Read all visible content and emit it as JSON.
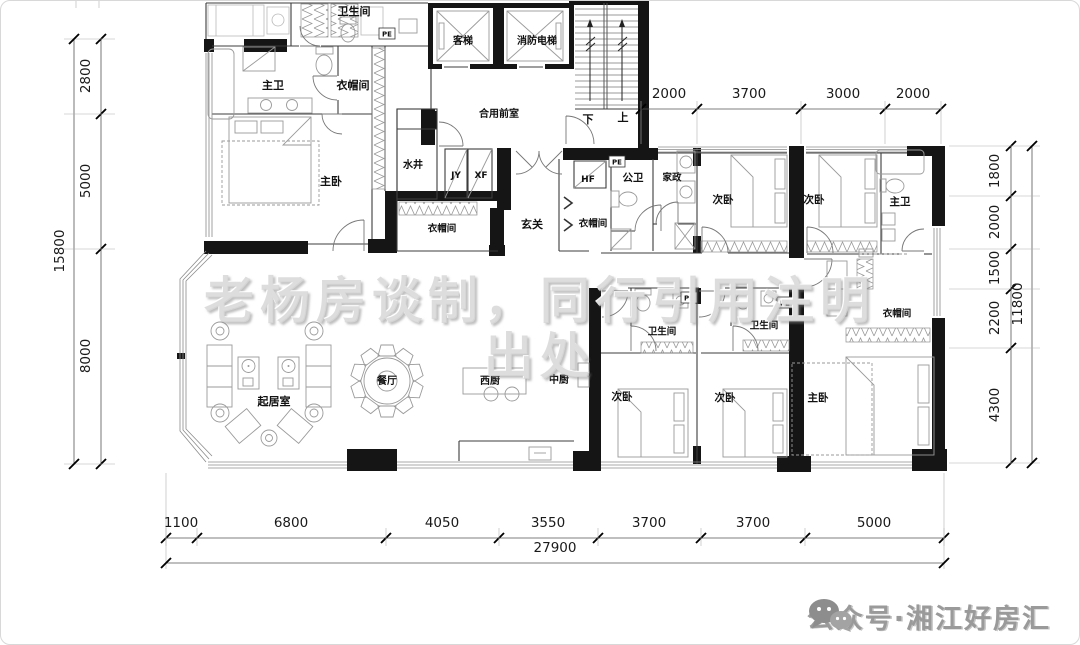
{
  "watermark": {
    "line1": "老杨房谈制，同行引用注明",
    "line2": "出处"
  },
  "footer_logo": {
    "icon": "wechat-bubbles-icon",
    "text": "公众号·湘江好房汇"
  },
  "room_labels": [
    {
      "id": "bath-top",
      "label": "卫生间",
      "x": 353,
      "y": 11,
      "size": 11
    },
    {
      "id": "master-bath-1",
      "label": "主卫",
      "x": 272,
      "y": 85,
      "size": 11
    },
    {
      "id": "closet-1",
      "label": "衣帽间",
      "x": 352,
      "y": 85,
      "size": 11
    },
    {
      "id": "master-bed-1",
      "label": "主卧",
      "x": 330,
      "y": 181,
      "size": 11
    },
    {
      "id": "water-well",
      "label": "水井",
      "x": 412,
      "y": 164,
      "size": 10
    },
    {
      "id": "elevator-passenger",
      "label": "客梯",
      "x": 462,
      "y": 40,
      "size": 10
    },
    {
      "id": "elevator-fire",
      "label": "消防电梯",
      "x": 536,
      "y": 40,
      "size": 10
    },
    {
      "id": "shared-lobby",
      "label": "合用前室",
      "x": 498,
      "y": 113,
      "size": 10
    },
    {
      "id": "stair-down",
      "label": "下",
      "x": 587,
      "y": 119,
      "size": 11
    },
    {
      "id": "stair-up",
      "label": "上",
      "x": 622,
      "y": 117,
      "size": 11
    },
    {
      "id": "foyer",
      "label": "玄关",
      "x": 531,
      "y": 224,
      "size": 11
    },
    {
      "id": "closet-2",
      "label": "衣帽间",
      "x": 441,
      "y": 228,
      "size": 9.5
    },
    {
      "id": "closet-3",
      "label": "衣帽间",
      "x": 592,
      "y": 223,
      "size": 9.5
    },
    {
      "id": "public-bath",
      "label": "公卫",
      "x": 632,
      "y": 177,
      "size": 10.5
    },
    {
      "id": "housekeeping",
      "label": "家政",
      "x": 671,
      "y": 177,
      "size": 9.5
    },
    {
      "id": "bedroom-2",
      "label": "次卧",
      "x": 722,
      "y": 199,
      "size": 10.5
    },
    {
      "id": "bedroom-3",
      "label": "次卧",
      "x": 813,
      "y": 199,
      "size": 10.5
    },
    {
      "id": "master-bath-2",
      "label": "主卫",
      "x": 899,
      "y": 201,
      "size": 10.5
    },
    {
      "id": "closet-4",
      "label": "衣帽间",
      "x": 896,
      "y": 313,
      "size": 9.5
    },
    {
      "id": "bath-mid-1",
      "label": "卫生间",
      "x": 661,
      "y": 331,
      "size": 9.5
    },
    {
      "id": "bath-mid-2",
      "label": "卫生间",
      "x": 763,
      "y": 325,
      "size": 9.5
    },
    {
      "id": "living-room",
      "label": "起居室",
      "x": 273,
      "y": 401,
      "size": 11
    },
    {
      "id": "dining-room",
      "label": "餐厅",
      "x": 386,
      "y": 380,
      "size": 10
    },
    {
      "id": "west-kitchen",
      "label": "西厨",
      "x": 489,
      "y": 380,
      "size": 10
    },
    {
      "id": "chinese-kitchen",
      "label": "中厨",
      "x": 558,
      "y": 379,
      "size": 10
    },
    {
      "id": "bedroom-4",
      "label": "次卧",
      "x": 621,
      "y": 396,
      "size": 10.5
    },
    {
      "id": "bedroom-5",
      "label": "次卧",
      "x": 724,
      "y": 397,
      "size": 10.5
    },
    {
      "id": "master-bed-2",
      "label": "主卧",
      "x": 817,
      "y": 397,
      "size": 10.5
    }
  ],
  "tiny_labels": [
    {
      "id": "shaft-jy",
      "label": "JY",
      "x": 455,
      "y": 174,
      "size": 9,
      "boxed": false
    },
    {
      "id": "shaft-xf",
      "label": "XF",
      "x": 480,
      "y": 174,
      "size": 9,
      "boxed": false
    },
    {
      "id": "shaft-hf",
      "label": "HF",
      "x": 587,
      "y": 178,
      "size": 9,
      "boxed": false
    },
    {
      "id": "pe-1",
      "label": "PE",
      "x": 386,
      "y": 33,
      "size": 7,
      "boxed": true
    },
    {
      "id": "pe-2",
      "label": "PE",
      "x": 616,
      "y": 161,
      "size": 7,
      "boxed": true
    },
    {
      "id": "pe-3",
      "label": "PE",
      "x": 688,
      "y": 297,
      "size": 7,
      "boxed": true
    },
    {
      "id": "pe-4",
      "label": "PE",
      "x": 784,
      "y": 302,
      "size": 7,
      "boxed": true
    }
  ],
  "dimensions": {
    "left": {
      "segment_line_x": 100,
      "total_line_x": 73,
      "start": 38,
      "end": 463,
      "ticks": [
        38,
        113,
        248,
        463
      ],
      "segments": [
        {
          "value": "2800",
          "mid": 75
        },
        {
          "value": "5000",
          "mid": 180
        },
        {
          "value": "8000",
          "mid": 355
        }
      ],
      "total": {
        "value": "15800",
        "mid": 250
      }
    },
    "right": {
      "segment_line_x": 1010,
      "total_line_x": 1031,
      "start": 145,
      "end": 462,
      "ticks": [
        145,
        195,
        248,
        288,
        347,
        462
      ],
      "segments": [
        {
          "value": "1800",
          "mid": 170
        },
        {
          "value": "2000",
          "mid": 221
        },
        {
          "value": "1500",
          "mid": 267
        },
        {
          "value": "2200",
          "mid": 317
        },
        {
          "value": "4300",
          "mid": 404
        }
      ],
      "total": {
        "value": "11800",
        "mid": 303
      }
    },
    "top": {
      "line_y": 108,
      "start": 640,
      "end": 940,
      "ticks": [
        640,
        696,
        800,
        884,
        940
      ],
      "segments": [
        {
          "value": "2000",
          "mid": 668
        },
        {
          "value": "3700",
          "mid": 748
        },
        {
          "value": "3000",
          "mid": 842
        },
        {
          "value": "2000",
          "mid": 912
        }
      ]
    },
    "bottom": {
      "segment_line_y": 537,
      "total_line_y": 562,
      "start": 165,
      "end": 943,
      "ticks": [
        165,
        196,
        385,
        498,
        597,
        700,
        804,
        943
      ],
      "segments": [
        {
          "value": "1100",
          "mid": 180
        },
        {
          "value": "6800",
          "mid": 290
        },
        {
          "value": "4050",
          "mid": 441
        },
        {
          "value": "3550",
          "mid": 547
        },
        {
          "value": "3700",
          "mid": 648
        },
        {
          "value": "3700",
          "mid": 752
        },
        {
          "value": "5000",
          "mid": 873
        }
      ],
      "total": {
        "value": "27900",
        "mid": 554
      }
    }
  }
}
